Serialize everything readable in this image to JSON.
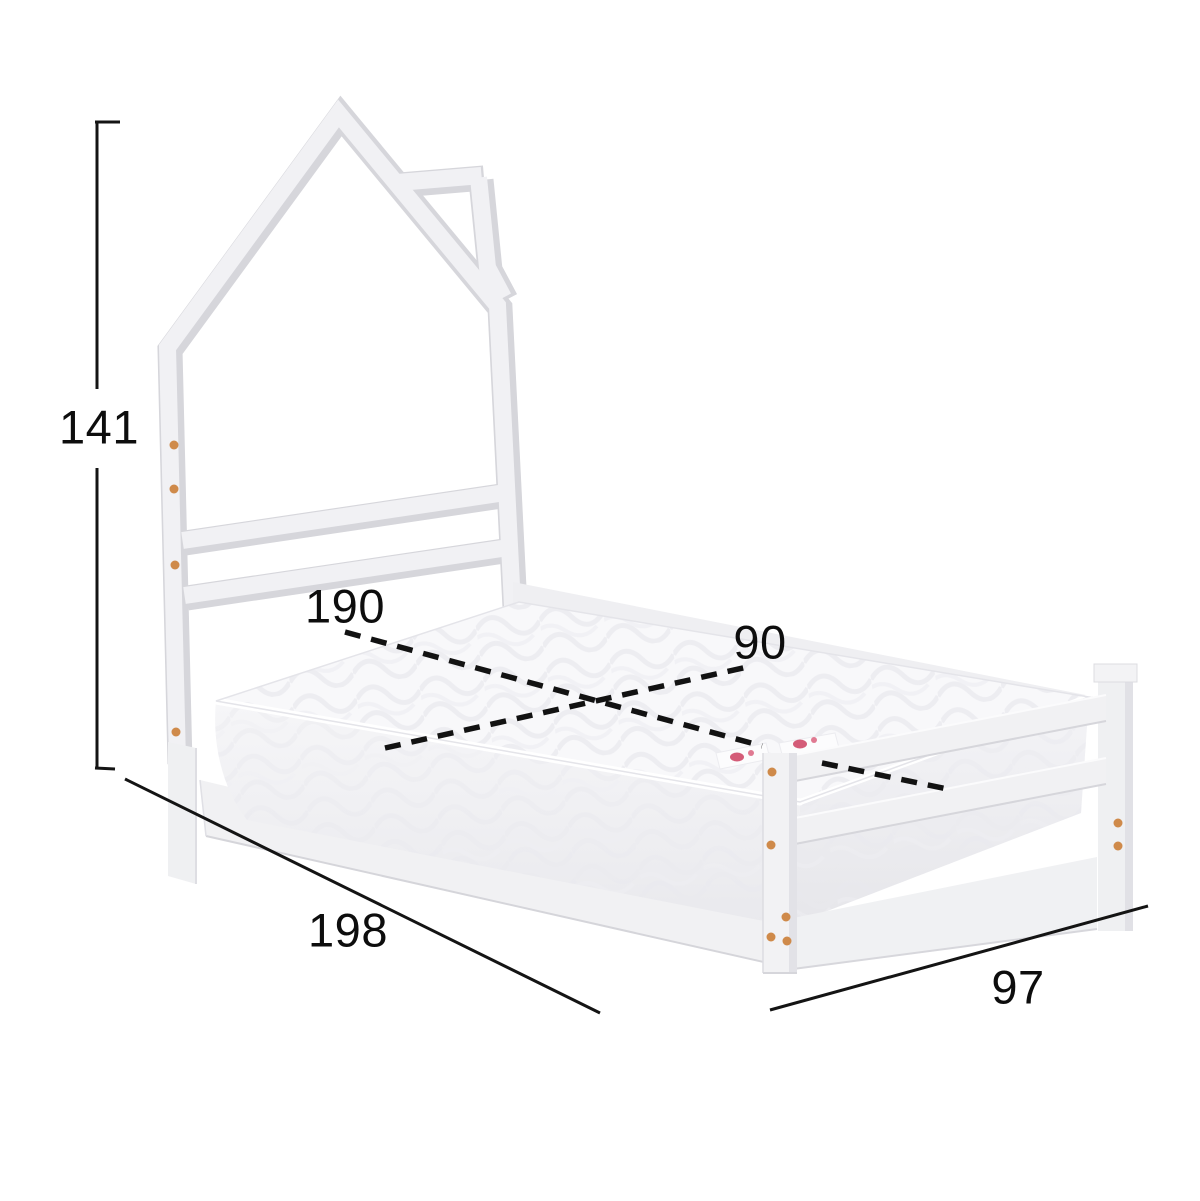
{
  "diagram": {
    "kind": "bed-dimension-diagram",
    "subject": "house-frame-kids-bed-with-mattress",
    "dimensions": {
      "height": "141",
      "mattress_length": "190",
      "mattress_width": "90",
      "overall_length": "198",
      "overall_width": "97"
    },
    "colors": {
      "background": "#ffffff",
      "frame_light": "#f1f1f4",
      "frame_shadow": "#d6d6db",
      "mattress_white": "#f8f8fa",
      "quilt_line": "#e9e9ee",
      "dimension_line": "#141414",
      "dashed_line": "#121212",
      "dowel_orange": "#cf8a4a",
      "mattress_tag_red": "#cc4060"
    }
  }
}
